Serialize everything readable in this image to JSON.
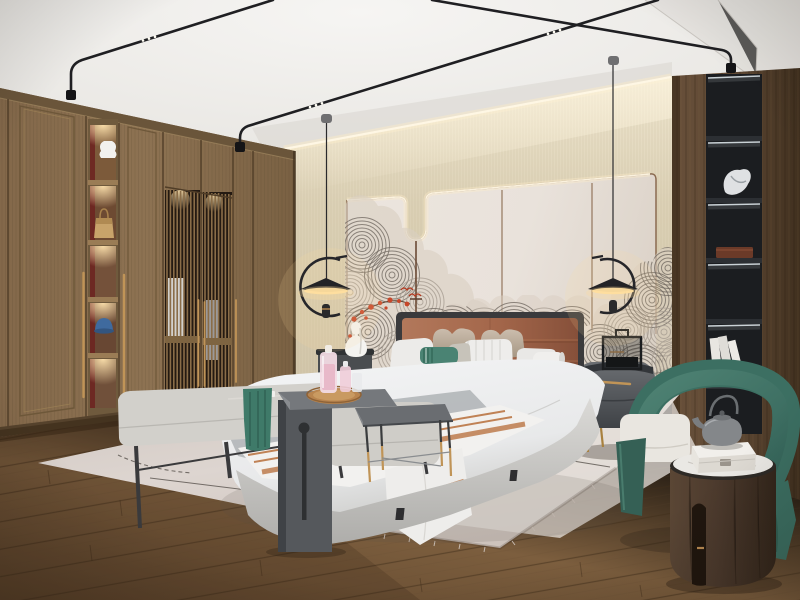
{
  "meta": {
    "title": "Photorealistic render of a modern new-Chinese style bedroom",
    "type": "interior-photograph",
    "width": 800,
    "height": 600
  },
  "scene": {
    "room": "bedroom",
    "style": "modern new-Chinese (Zen) style",
    "lighting": [
      "LED cove light along ceiling and wall panels",
      "two black disc pendant lamps with C-shaped arms",
      "warm downlights in wardrobe display niches",
      "strip lights in black display shelving"
    ],
    "objects": [
      "built-in wood wardrobe with lattice screen doors and brass pull handles",
      "wardrobe display niches holding a white vase, a tan handbag and a blue cap",
      "king bed with caramel leather channel-tufted headboard",
      "white, beige, striped and teal accent pillows with a fabric bolster",
      "white duvet, gray blanket and copper-striped white throw",
      "swirl-pattern mural wallpaper with red blossom branch and small red birds",
      "beige textured upper wall band with lit panel trim and hanging rod",
      "left nightstand with white gourd vase",
      "right gray nightstand with brass handle, legs and a black lantern object",
      "upholstered bench with teal throw and incense set",
      "dark gray waterfall side table with round wood tray and pink perfume bottles",
      "light gray ottoman and a metal side table with brass-tipped legs",
      "large light area rug with thin dark lines and two pinecones",
      "green fabric barrel armchair with white seat cushion",
      "round walnut drum side table with marble top, white gift box and gray teapot",
      "recessed black display shelving with sculpture, wooden box and white books",
      "black ceiling track lights with tiny LED spots",
      "oak plank flooring"
    ]
  },
  "colors": {
    "ceiling": "#edebe8",
    "wallBeige": "#dcd1b6",
    "wallPanel": "#e9e2db",
    "trimBrown": "#8a6a50",
    "ledGlow": "#fff3d8",
    "muralStroke": "#6e665e",
    "muralRed": "#c7472a",
    "wardrobeWood": "#8d7252",
    "wardrobeDark": "#5f4a31",
    "nicheRed": "#6d2521",
    "brass": "#c09457",
    "latticeDark": "#241a12",
    "columnWood": "#5d4733",
    "shelfBlack": "#212427",
    "floorWood": "#81613f",
    "rug": "#d7cdc7",
    "headboard": "#a86b4e",
    "bedWhite": "#eef0f1",
    "blanketGray": "#b5b8ba",
    "throwCopper": "#c08255",
    "pillowTeal": "#4a8373",
    "benchGray": "#d2d0cb",
    "tableDark": "#55585c",
    "trayWood": "#b9854f",
    "bottlePink": "#e8b9c9",
    "chairGreen": "#417265",
    "cushionWhite": "#e9e6e0",
    "drumWood": "#4c3a2d",
    "marble": "#eae8e4",
    "nightstandGray": "#54575b",
    "lampBlack": "#232326",
    "glowWarm": "#ffdf9e",
    "pinecone": "#5a4028"
  }
}
